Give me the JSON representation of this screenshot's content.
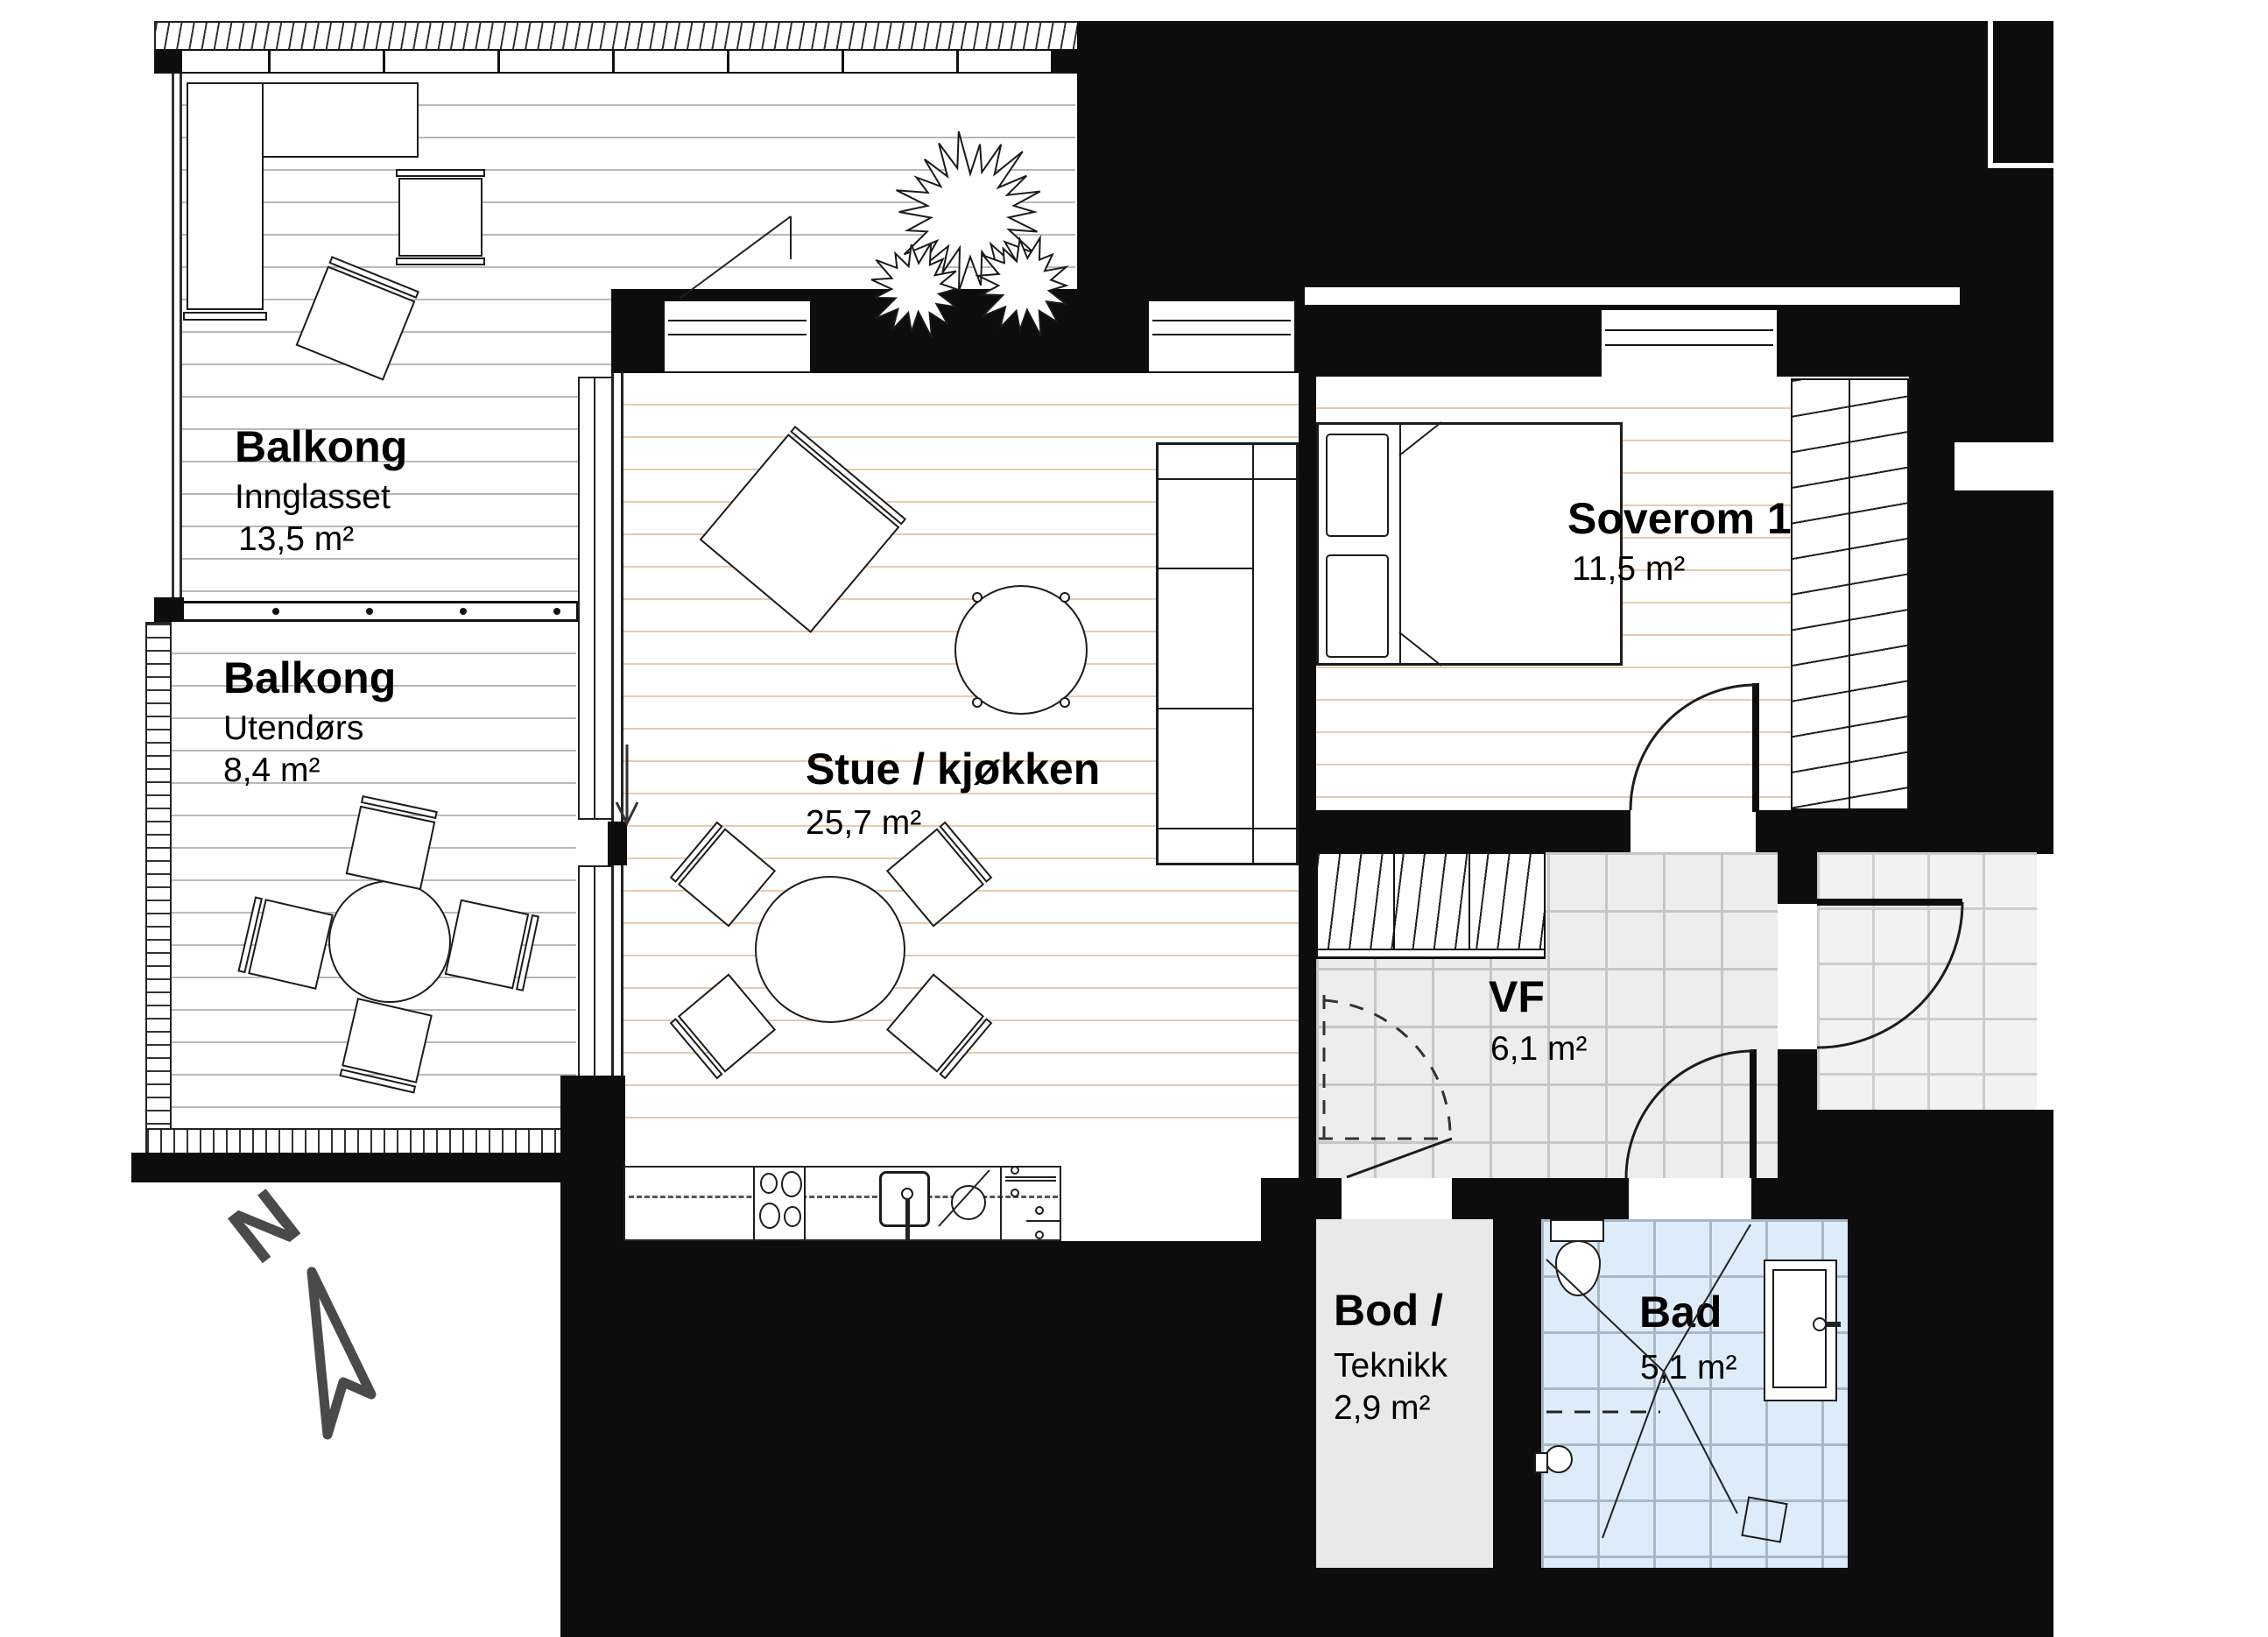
{
  "plan_title": "Apartment floor plan",
  "rooms": {
    "balkong_innglasset": {
      "name": "Balkong",
      "type": "Innglasset",
      "area": "13,5 m²"
    },
    "balkong_utendors": {
      "name": "Balkong",
      "type": "Utendørs",
      "area": "8,4 m²"
    },
    "stue_kjokken": {
      "name": "Stue / kjøkken",
      "area": "25,7 m²"
    },
    "soverom_1": {
      "name": "Soverom 1",
      "area": "11,5 m²"
    },
    "vf": {
      "name": "VF",
      "area": "6,1 m²"
    },
    "bod_teknikk": {
      "name": "Bod /",
      "type": "Teknikk",
      "area": "2,9 m²"
    },
    "bad": {
      "name": "Bad",
      "area": "5,1 m²"
    }
  },
  "compass": {
    "north_label": "N"
  },
  "colors": {
    "wall": "#0d0d0d",
    "wood_floor_line": "#e5cbb0",
    "deck_line": "#b9b9b9",
    "vf_tile": "#ededed",
    "vf_grout": "#c6c6c6",
    "bath_tile": "#ddecf8",
    "bath_grout": "#a9b8c6",
    "bod_floor": "#e9e9e9",
    "porch_tile": "#f2f2f2",
    "north_arrow": "#4a4a4a"
  }
}
